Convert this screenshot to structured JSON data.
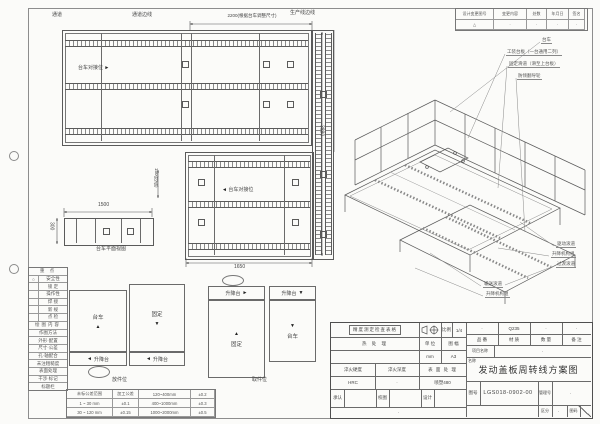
{
  "revision": {
    "headers": [
      "设计变更图号",
      "变更内容",
      "处数",
      "年月日",
      "签名"
    ],
    "values": [
      "△",
      "·",
      "·",
      "·",
      "·"
    ]
  },
  "top_labels": {
    "passage": "通道",
    "passage_edge": "通道边线",
    "dim_2200": "2200(根据台车调整尺寸)",
    "production_edge": "生产线边线"
  },
  "plan": {
    "dock_label": "台车对接位",
    "dim_3880": "3880",
    "dim_1650": "1650",
    "dim_1500": "1500",
    "dim_300": "300",
    "dim_150": "150(可调)",
    "trolley_caption": "台车平面视图"
  },
  "iso": {
    "labels_top": [
      "台车",
      "工装台板（一台通用二列）",
      "固定滑道（滑至上台板）",
      "防倾翻导轮"
    ],
    "labels_bottom": [
      "驱动滚道",
      "升降机构组",
      "过渡滚道"
    ],
    "labels_mid": [
      "输送滚道",
      "升降机构组"
    ]
  },
  "legend": {
    "title": "重  点",
    "rows1": [
      {
        "mark": "○",
        "label": "安全性"
      },
      {
        "mark": "",
        "label": "锁  定"
      },
      {
        "mark": "",
        "label": "操作性"
      },
      {
        "mark": "",
        "label": "焊  接"
      },
      {
        "mark": "",
        "label": "新  规"
      },
      {
        "mark": "",
        "label": "点  检"
      }
    ],
    "section2": "绘图内容",
    "rows2": [
      "作图方法",
      "外形·配置",
      "尺寸·公差",
      "孔·轴配合",
      "未注粗糙度",
      "表面处理",
      "干涉·标记",
      "标题栏"
    ]
  },
  "tolerance": {
    "rows": [
      [
        "未标公差范围",
        "加工公差",
        "120~400mm",
        "±0.2"
      ],
      [
        "1 ~ 30 mm",
        "±0.1",
        "400~1000mm",
        "±0.3"
      ],
      [
        "30 ~ 120 mm",
        "±0.15",
        "1000~2000mm",
        "±0.5"
      ]
    ]
  },
  "sketches": {
    "trolley": "台车",
    "fixed": "固定",
    "lift": "升降台",
    "caption_left": "放件位",
    "caption_right": "取件位"
  },
  "glyphs": {
    "up": "▲",
    "down": "▼",
    "left": "◄",
    "right": "►"
  },
  "titleblock": {
    "inspect": "精度测定检查表格",
    "scale_label": "比例",
    "scale_value": "1/4",
    "heat": "热  处  理",
    "unit_label": "单 位",
    "unit_value": "mm",
    "sheet_label": "图 幅",
    "sheet_value": "A3",
    "hard_label": "淬火硬度",
    "hard_value": "HRC",
    "depth_label": "淬火深度",
    "depth_value": "·",
    "surface_label": "表 面 处 理",
    "surface_value": "喷塑480",
    "approve": "承认",
    "check": "校图",
    "design": "设计",
    "sign_dot": "·",
    "part_label": "品 番",
    "part_value": "·",
    "material_label": "材 质",
    "material_value": "Q235",
    "qty_label": "数 量",
    "qty_value": "·",
    "remark_label": "备 注",
    "remark_value": "·",
    "project_label": "项目名称",
    "project_value": "·",
    "name_label": "名称",
    "title": "发动盖板周转线方案图",
    "dwgno_label": "图号",
    "dwgno": "LGS018-0902-00",
    "mgmt_label": "管理号",
    "mgmt_value": "·",
    "class_label": "区分",
    "class_value": "·",
    "code_label": "图码"
  }
}
